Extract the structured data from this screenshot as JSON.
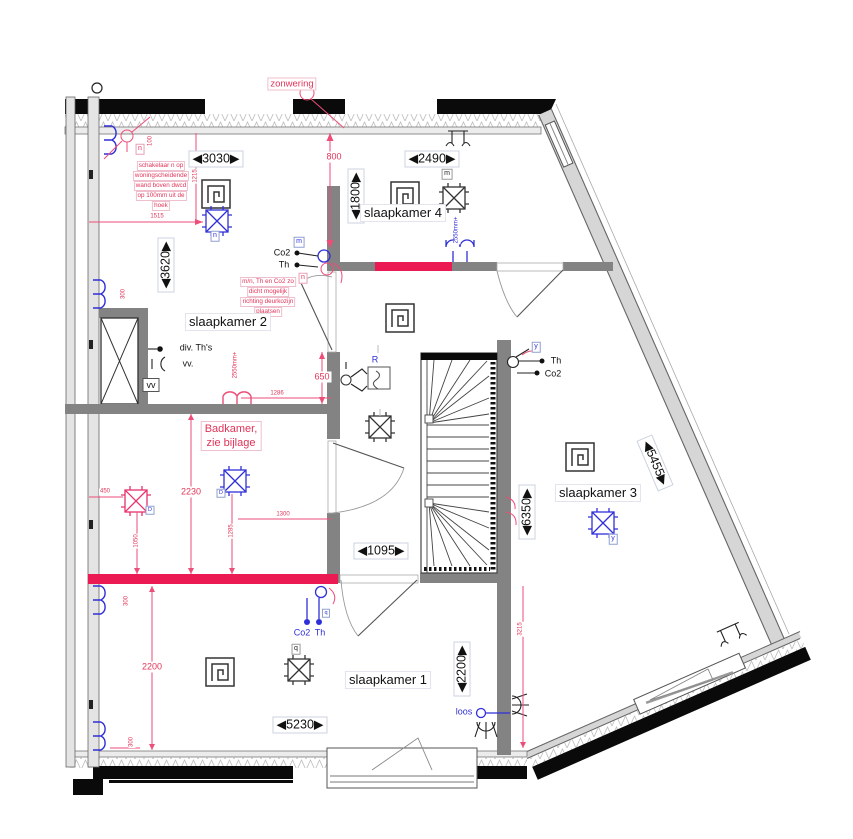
{
  "colors": {
    "interior_wall_grey": "#838383",
    "exterior_wall_grey": "#d6d6d6",
    "new_wall_red": "#ec1a52",
    "annotation_red": "#e23358",
    "annotation_blue": "#2f2fd8",
    "outline_black": "#0a0a0a"
  },
  "rooms": {
    "slaapkamer2": "slaapkamer 2",
    "slaapkamer4": "slaapkamer 4",
    "slaapkamer3": "slaapkamer 3",
    "slaapkamer1": "slaapkamer 1"
  },
  "dims": {
    "w3030": "◀3030▶",
    "w2490": "◀2490▶",
    "v1800": "◀1800▶",
    "v3620": "◀3620▶",
    "v6350": "◀6350▶",
    "d5455": "◀5455▶",
    "w1095": "◀1095▶",
    "w5230": "◀5230▶",
    "v2200": "◀2200▶"
  },
  "red_dims": {
    "d800": "800",
    "d650": "650",
    "d2230": "2230",
    "d2200": "2200",
    "d1515": "1515",
    "d1215": "1215",
    "d1286": "1286",
    "d1300": "1300",
    "d450": "450",
    "d1050": "1050",
    "d1285": "1285",
    "d3215": "3215",
    "d100": "100",
    "d300": "300"
  },
  "notes": {
    "zonwering": "zonwering",
    "switch_note": [
      "schakelaar n op",
      "woningscheidende",
      "wand boven dwcd",
      "op 100mm uit de",
      "hoek"
    ],
    "sensor_note": [
      "m/n, Th en Co2 zo",
      "dicht mogelijk",
      "richting deurkozijn",
      "plaatsen"
    ],
    "badkamer": [
      "Badkamer,",
      "zie bijlage"
    ]
  },
  "sensor_labels": {
    "co2": "Co2",
    "th": "Th",
    "div_ths": "div. Th's",
    "vv_period": "vv.",
    "vv": "vv",
    "loos": "loos",
    "r": "R"
  },
  "tags": {
    "m": "m",
    "n": "n",
    "q": "q",
    "y": "y",
    "d": "D",
    "h2550": "2550mm+"
  }
}
